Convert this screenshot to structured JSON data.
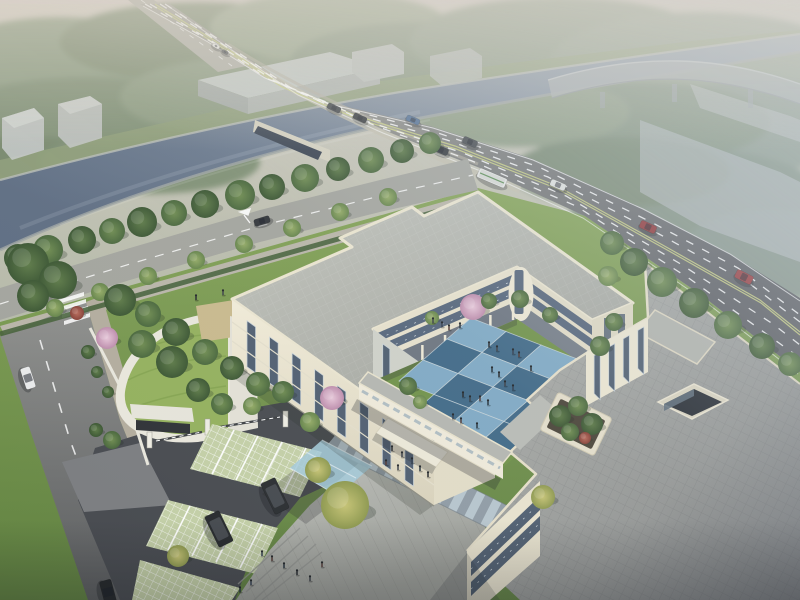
{
  "meta": {
    "label": "aerial-architectural-rendering",
    "subject": "campus building complex with canal highway bridge"
  },
  "colors": {
    "sky_top": "#d3ccc2",
    "water": "#5d6c81",
    "fog": "#cdd6de",
    "road": "#8f9089",
    "road_line": "#cdd383",
    "street": "#a3a49d",
    "sidewalk": "#b3ac9d",
    "asphalt": "#474a4f",
    "apron": "#7b7d80",
    "plaza": "#b4b6b0",
    "lawn": "#7c9b51",
    "lawn_bright": "#6f9147",
    "green_roof": "#93b05c",
    "sand_patch": "#c9b98c",
    "wall_cream": "#ece6d1",
    "wall_shade": "#cfd1c9",
    "glass": "#4e5d6f",
    "roof_gray": "#b5b7b0",
    "roof_east": "#a2a49f",
    "tile_light": "#7fa9c4",
    "tile_dark": "#3f6886",
    "grout": "#c8d4da",
    "paver_green": "#c3cfa6",
    "canopy_blue": "#a4c9d8",
    "canopy_white": "#ece8d8"
  },
  "scene": {
    "courtyard": {
      "origin": [
        471,
        318
      ],
      "e1": [
        35,
        13.5
      ],
      "e2": [
        -24,
        21
      ],
      "cols": 4,
      "rows": 3,
      "pattern": [
        [
          "L",
          "D",
          "L",
          "L"
        ],
        [
          "D",
          "L",
          "D",
          "L"
        ],
        [
          "L",
          "D",
          "L",
          "D"
        ]
      ],
      "extras": [
        [
          1,
          3,
          "D"
        ],
        [
          2,
          3,
          "L"
        ],
        [
          3,
          3,
          "D"
        ],
        [
          4,
          2,
          "L"
        ]
      ]
    },
    "facade": {
      "ax": 232,
      "ay": 300,
      "bx": 420,
      "by": 435,
      "strips": 8,
      "top": 10,
      "bottom": 56,
      "width": 8.5
    },
    "east_wall": {
      "ax": 590,
      "ay": 350,
      "bx": 642,
      "by": 320,
      "strips": 4,
      "top": 8,
      "bottom": 46,
      "width": 6
    },
    "ne_wall": {
      "ax": 373,
      "ay": 329,
      "bx": 495,
      "by": 416,
      "strips": 4,
      "top": 8,
      "bottom": 42,
      "width": 7
    },
    "colonnades": [
      {
        "ax": 513,
        "ay": 305,
        "bx": 377,
        "by": 365,
        "n": 7
      },
      {
        "ax": 521,
        "ay": 307,
        "bx": 588,
        "by": 354,
        "n": 4
      }
    ],
    "trees": [
      {
        "x": 18,
        "y": 258,
        "r": 14,
        "t": "d"
      },
      {
        "x": 48,
        "y": 250,
        "r": 15,
        "t": "m"
      },
      {
        "x": 82,
        "y": 240,
        "r": 14,
        "t": "d"
      },
      {
        "x": 112,
        "y": 231,
        "r": 13,
        "t": "m"
      },
      {
        "x": 142,
        "y": 222,
        "r": 15,
        "t": "d"
      },
      {
        "x": 174,
        "y": 213,
        "r": 13,
        "t": "m"
      },
      {
        "x": 205,
        "y": 204,
        "r": 14,
        "t": "d"
      },
      {
        "x": 240,
        "y": 195,
        "r": 15,
        "t": "m"
      },
      {
        "x": 272,
        "y": 187,
        "r": 13,
        "t": "d"
      },
      {
        "x": 305,
        "y": 178,
        "r": 14,
        "t": "m"
      },
      {
        "x": 338,
        "y": 169,
        "r": 12,
        "t": "d"
      },
      {
        "x": 371,
        "y": 160,
        "r": 13,
        "t": "m"
      },
      {
        "x": 402,
        "y": 151,
        "r": 12,
        "t": "d"
      },
      {
        "x": 430,
        "y": 143,
        "r": 11,
        "t": "m"
      },
      {
        "x": 28,
        "y": 264,
        "r": 21,
        "t": "d"
      },
      {
        "x": 58,
        "y": 280,
        "r": 19,
        "t": "d"
      },
      {
        "x": 33,
        "y": 296,
        "r": 16,
        "t": "d"
      },
      {
        "x": 55,
        "y": 308,
        "r": 9,
        "t": "l"
      },
      {
        "x": 100,
        "y": 292,
        "r": 9,
        "t": "l"
      },
      {
        "x": 148,
        "y": 276,
        "r": 9,
        "t": "l"
      },
      {
        "x": 196,
        "y": 260,
        "r": 9,
        "t": "l"
      },
      {
        "x": 244,
        "y": 244,
        "r": 9,
        "t": "l"
      },
      {
        "x": 292,
        "y": 228,
        "r": 9,
        "t": "l"
      },
      {
        "x": 340,
        "y": 212,
        "r": 9,
        "t": "l"
      },
      {
        "x": 388,
        "y": 197,
        "r": 9,
        "t": "l"
      },
      {
        "x": 612,
        "y": 243,
        "r": 12,
        "t": "m"
      },
      {
        "x": 634,
        "y": 262,
        "r": 14,
        "t": "d"
      },
      {
        "x": 662,
        "y": 282,
        "r": 15,
        "t": "m"
      },
      {
        "x": 694,
        "y": 303,
        "r": 15,
        "t": "d"
      },
      {
        "x": 728,
        "y": 325,
        "r": 14,
        "t": "m"
      },
      {
        "x": 762,
        "y": 346,
        "r": 13,
        "t": "d"
      },
      {
        "x": 790,
        "y": 364,
        "r": 12,
        "t": "m"
      },
      {
        "x": 608,
        "y": 276,
        "r": 10,
        "t": "l"
      },
      {
        "x": 120,
        "y": 300,
        "r": 16,
        "t": "d"
      },
      {
        "x": 148,
        "y": 314,
        "r": 13,
        "t": "m"
      },
      {
        "x": 176,
        "y": 332,
        "r": 14,
        "t": "d"
      },
      {
        "x": 205,
        "y": 352,
        "r": 13,
        "t": "m"
      },
      {
        "x": 172,
        "y": 362,
        "r": 16,
        "t": "d"
      },
      {
        "x": 142,
        "y": 344,
        "r": 14,
        "t": "m"
      },
      {
        "x": 232,
        "y": 368,
        "r": 12,
        "t": "d"
      },
      {
        "x": 258,
        "y": 384,
        "r": 12,
        "t": "m"
      },
      {
        "x": 198,
        "y": 390,
        "r": 12,
        "t": "d"
      },
      {
        "x": 222,
        "y": 404,
        "r": 11,
        "t": "m"
      },
      {
        "x": 107,
        "y": 338,
        "r": 11,
        "t": "p"
      },
      {
        "x": 77,
        "y": 313,
        "r": 7,
        "t": "r"
      },
      {
        "x": 332,
        "y": 398,
        "r": 12,
        "t": "p"
      },
      {
        "x": 310,
        "y": 422,
        "r": 10,
        "t": "l"
      },
      {
        "x": 283,
        "y": 392,
        "r": 11,
        "t": "m"
      },
      {
        "x": 252,
        "y": 406,
        "r": 9,
        "t": "l"
      },
      {
        "x": 112,
        "y": 440,
        "r": 9,
        "t": "m"
      },
      {
        "x": 96,
        "y": 430,
        "r": 7,
        "t": "d"
      },
      {
        "x": 345,
        "y": 505,
        "r": 24,
        "t": "y"
      },
      {
        "x": 318,
        "y": 470,
        "r": 13,
        "t": "y"
      },
      {
        "x": 178,
        "y": 556,
        "r": 11,
        "t": "y"
      },
      {
        "x": 543,
        "y": 497,
        "r": 12,
        "t": "y"
      },
      {
        "x": 473,
        "y": 307,
        "r": 13,
        "t": "p"
      },
      {
        "x": 489,
        "y": 301,
        "r": 8,
        "t": "m"
      },
      {
        "x": 520,
        "y": 299,
        "r": 9,
        "t": "m"
      },
      {
        "x": 550,
        "y": 315,
        "r": 8,
        "t": "m"
      },
      {
        "x": 600,
        "y": 346,
        "r": 10,
        "t": "m"
      },
      {
        "x": 614,
        "y": 322,
        "r": 9,
        "t": "m"
      },
      {
        "x": 408,
        "y": 386,
        "r": 9,
        "t": "m"
      },
      {
        "x": 420,
        "y": 402,
        "r": 7,
        "t": "l"
      },
      {
        "x": 432,
        "y": 318,
        "r": 7,
        "t": "l"
      },
      {
        "x": 560,
        "y": 416,
        "r": 11,
        "t": "d"
      },
      {
        "x": 578,
        "y": 406,
        "r": 10,
        "t": "m"
      },
      {
        "x": 592,
        "y": 424,
        "r": 11,
        "t": "d"
      },
      {
        "x": 570,
        "y": 432,
        "r": 9,
        "t": "m"
      },
      {
        "x": 585,
        "y": 438,
        "r": 6,
        "t": "r"
      },
      {
        "x": 88,
        "y": 352,
        "r": 7,
        "t": "d"
      },
      {
        "x": 97,
        "y": 372,
        "r": 6,
        "t": "d"
      },
      {
        "x": 108,
        "y": 392,
        "r": 6,
        "t": "d"
      }
    ],
    "people": [
      [
        489,
        347
      ],
      [
        497,
        351
      ],
      [
        513,
        354
      ],
      [
        519,
        357
      ],
      [
        492,
        372
      ],
      [
        499,
        377
      ],
      [
        505,
        386
      ],
      [
        513,
        390
      ],
      [
        480,
        401
      ],
      [
        488,
        405
      ],
      [
        463,
        397
      ],
      [
        470,
        401
      ],
      [
        453,
        419
      ],
      [
        461,
        423
      ],
      [
        477,
        428
      ],
      [
        531,
        371
      ],
      [
        433,
        323
      ],
      [
        442,
        327
      ],
      [
        449,
        330
      ],
      [
        460,
        328
      ],
      [
        196,
        300
      ],
      [
        223,
        295
      ],
      [
        262,
        556
      ],
      [
        272,
        561
      ],
      [
        284,
        568
      ],
      [
        297,
        575
      ],
      [
        310,
        581
      ],
      [
        251,
        585
      ],
      [
        322,
        567
      ],
      [
        240,
        592
      ],
      [
        392,
        451
      ],
      [
        402,
        457
      ],
      [
        412,
        463
      ],
      [
        386,
        465
      ],
      [
        420,
        471
      ],
      [
        428,
        477
      ],
      [
        398,
        470
      ]
    ],
    "vehicles": [
      {
        "x": 216,
        "y": 46,
        "l": 8,
        "w": 4,
        "rot": 29,
        "c": "#e8e9e6",
        "t": "car"
      },
      {
        "x": 225,
        "y": 52,
        "l": 7,
        "w": 3.5,
        "rot": 29,
        "c": "#55595c",
        "t": "car"
      },
      {
        "x": 334,
        "y": 108,
        "l": 14,
        "w": 6,
        "rot": 25,
        "c": "#3a3e42",
        "t": "car"
      },
      {
        "x": 360,
        "y": 118,
        "l": 14,
        "w": 6,
        "rot": 25,
        "c": "#2f3337",
        "t": "car"
      },
      {
        "x": 413,
        "y": 120,
        "l": 14,
        "w": 6,
        "rot": 23,
        "c": "#4a6a92",
        "t": "car"
      },
      {
        "x": 441,
        "y": 150,
        "l": 15,
        "w": 7,
        "rot": 23,
        "c": "#33373b",
        "t": "car"
      },
      {
        "x": 470,
        "y": 142,
        "l": 15,
        "w": 7,
        "rot": 23,
        "c": "#43474b",
        "t": "car"
      },
      {
        "x": 492,
        "y": 178,
        "l": 30,
        "w": 10,
        "rot": 23,
        "c": "#e6e7e3",
        "t": "bus"
      },
      {
        "x": 558,
        "y": 185,
        "l": 16,
        "w": 7,
        "rot": 23,
        "c": "#dfe1de",
        "t": "car"
      },
      {
        "x": 648,
        "y": 227,
        "l": 17,
        "w": 8,
        "rot": 25,
        "c": "#8e3032",
        "t": "car"
      },
      {
        "x": 744,
        "y": 277,
        "l": 18,
        "w": 9,
        "rot": 27,
        "c": "#96373a",
        "t": "car"
      },
      {
        "x": 262,
        "y": 221,
        "l": 16,
        "w": 7,
        "rot": -17,
        "c": "#303438",
        "t": "car"
      },
      {
        "x": 28,
        "y": 378,
        "l": 22,
        "w": 10,
        "rot": 72,
        "c": "#e9eaea",
        "t": "car"
      },
      {
        "x": 108,
        "y": 592,
        "l": 24,
        "w": 12,
        "rot": 75,
        "c": "#232629",
        "t": "car"
      },
      {
        "x": 275,
        "y": 496,
        "l": 34,
        "w": 16,
        "rot": 64,
        "c": "#2a2d30",
        "t": "suv"
      },
      {
        "x": 219,
        "y": 529,
        "l": 34,
        "w": 16,
        "rot": 64,
        "c": "#26292c",
        "t": "suv"
      }
    ]
  }
}
